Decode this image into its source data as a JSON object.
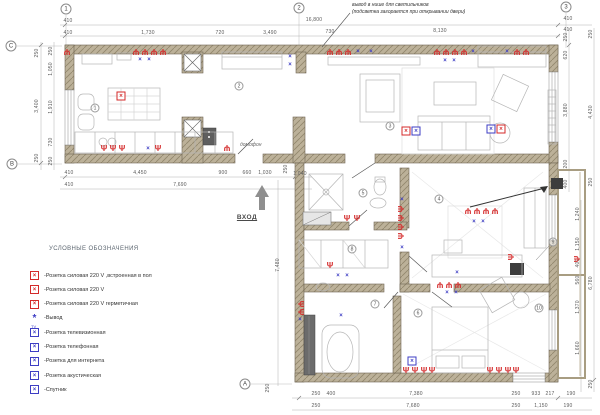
{
  "annotation": {
    "line1": "вывод в нише для светильников",
    "line2": "(подсветка загорается при открывании двери)"
  },
  "entrance": {
    "label": "ВХОД"
  },
  "intercom": {
    "label": "домофон"
  },
  "colors": {
    "socket_red": "#d42a2a",
    "signal_blue": "#3d3dc4",
    "wall_fill": "#b8ad93"
  },
  "legend": {
    "title": "УСЛОВНЫЕ ОБОЗНАЧЕНИЯ",
    "items": [
      {
        "icon": "floor-power-socket-icon",
        "style": "box",
        "color": "#d42a2a",
        "tag": "",
        "label": "-Розетка силовая 220 V ,встроенная в пол"
      },
      {
        "icon": "power-socket-icon",
        "style": "box",
        "color": "#d42a2a",
        "tag": "",
        "label": "-Розетка силовая 220 V"
      },
      {
        "icon": "sealed-power-socket-icon",
        "style": "box",
        "color": "#d42a2a",
        "tag": "",
        "label": "-Розетка силовая 220 V герметичная"
      },
      {
        "icon": "output-icon",
        "style": "dot",
        "color": "#3d3dc4",
        "tag": "",
        "label": "-Вывод"
      },
      {
        "icon": "tv-socket-icon",
        "style": "box",
        "color": "#3d3dc4",
        "tag": "TV",
        "label": "-Розетка телевизионная"
      },
      {
        "icon": "phone-socket-icon",
        "style": "box",
        "color": "#3d3dc4",
        "tag": "",
        "label": "-Розетка  телефонная"
      },
      {
        "icon": "internet-socket-icon",
        "style": "box",
        "color": "#3d3dc4",
        "tag": "",
        "label": "-Розетка  для интернета"
      },
      {
        "icon": "acoustic-socket-icon",
        "style": "box",
        "color": "#3d3dc4",
        "tag": "",
        "label": "-Розетка  акустическая"
      },
      {
        "icon": "satellite-icon",
        "style": "box",
        "color": "#3d3dc4",
        "tag": "",
        "label": "-Спутник"
      }
    ]
  },
  "grid_bubbles": [
    {
      "label": "1",
      "x": 66,
      "y": 9
    },
    {
      "label": "2",
      "x": 299,
      "y": 8
    },
    {
      "label": "3",
      "x": 566,
      "y": 7
    },
    {
      "label": "C",
      "x": 11,
      "y": 46
    },
    {
      "label": "B",
      "x": 12,
      "y": 164
    },
    {
      "label": "A",
      "x": 245,
      "y": 384
    }
  ],
  "room_numbers": [
    {
      "n": "1",
      "x": 95,
      "y": 108
    },
    {
      "n": "2",
      "x": 239,
      "y": 86
    },
    {
      "n": "3",
      "x": 390,
      "y": 126
    },
    {
      "n": "4",
      "x": 439,
      "y": 199
    },
    {
      "n": "5",
      "x": 363,
      "y": 193
    },
    {
      "n": "6",
      "x": 418,
      "y": 313
    },
    {
      "n": "7",
      "x": 375,
      "y": 304
    },
    {
      "n": "8",
      "x": 352,
      "y": 249
    },
    {
      "n": "9",
      "x": 553,
      "y": 242
    },
    {
      "n": "10",
      "x": 539,
      "y": 308
    }
  ],
  "dimensions": [
    {
      "t": "410",
      "x": 68,
      "y": 21
    },
    {
      "t": "16,800",
      "x": 314,
      "y": 20
    },
    {
      "t": "410",
      "x": 568,
      "y": 19
    },
    {
      "t": "410",
      "x": 68,
      "y": 33
    },
    {
      "t": "1,730",
      "x": 148,
      "y": 33
    },
    {
      "t": "720",
      "x": 220,
      "y": 33
    },
    {
      "t": "3,490",
      "x": 270,
      "y": 33
    },
    {
      "t": "730",
      "x": 330,
      "y": 32
    },
    {
      "t": "8,130",
      "x": 440,
      "y": 31
    },
    {
      "t": "410",
      "x": 568,
      "y": 30
    },
    {
      "t": "410",
      "x": 69,
      "y": 173
    },
    {
      "t": "4,450",
      "x": 140,
      "y": 173
    },
    {
      "t": "900",
      "x": 223,
      "y": 173
    },
    {
      "t": "660",
      "x": 247,
      "y": 173
    },
    {
      "t": "1,030",
      "x": 265,
      "y": 173
    },
    {
      "t": "1,040",
      "x": 300,
      "y": 174
    },
    {
      "t": "410",
      "x": 69,
      "y": 185
    },
    {
      "t": "7,690",
      "x": 180,
      "y": 185
    },
    {
      "t": "250",
      "x": 316,
      "y": 394
    },
    {
      "t": "400",
      "x": 331,
      "y": 394
    },
    {
      "t": "7,380",
      "x": 416,
      "y": 394
    },
    {
      "t": "250",
      "x": 516,
      "y": 394
    },
    {
      "t": "933",
      "x": 536,
      "y": 394
    },
    {
      "t": "217",
      "x": 550,
      "y": 394
    },
    {
      "t": "190",
      "x": 571,
      "y": 394
    },
    {
      "t": "250",
      "x": 316,
      "y": 406
    },
    {
      "t": "7,680",
      "x": 413,
      "y": 406
    },
    {
      "t": "250",
      "x": 516,
      "y": 406
    },
    {
      "t": "1,150",
      "x": 541,
      "y": 406
    },
    {
      "t": "190",
      "x": 568,
      "y": 406
    },
    {
      "t": "250",
      "x": 37,
      "y": 53,
      "r": 1
    },
    {
      "t": "3,400",
      "x": 37,
      "y": 106,
      "r": 1
    },
    {
      "t": "250",
      "x": 37,
      "y": 158,
      "r": 1
    },
    {
      "t": "250",
      "x": 51,
      "y": 51,
      "r": 1
    },
    {
      "t": "1,050",
      "x": 51,
      "y": 69,
      "r": 1
    },
    {
      "t": "1,910",
      "x": 51,
      "y": 107,
      "r": 1
    },
    {
      "t": "730",
      "x": 51,
      "y": 142,
      "r": 1
    },
    {
      "t": "250",
      "x": 51,
      "y": 161,
      "r": 1
    },
    {
      "t": "250",
      "x": 566,
      "y": 37,
      "r": 1
    },
    {
      "t": "620",
      "x": 566,
      "y": 55,
      "r": 1
    },
    {
      "t": "3,880",
      "x": 566,
      "y": 110,
      "r": 1
    },
    {
      "t": "200",
      "x": 566,
      "y": 164,
      "r": 1
    },
    {
      "t": "400",
      "x": 566,
      "y": 184,
      "r": 1
    },
    {
      "t": "1,240",
      "x": 578,
      "y": 214,
      "r": 1
    },
    {
      "t": "1,150",
      "x": 578,
      "y": 244,
      "r": 1
    },
    {
      "t": "400",
      "x": 578,
      "y": 263,
      "r": 1
    },
    {
      "t": "560",
      "x": 578,
      "y": 280,
      "r": 1
    },
    {
      "t": "1,370",
      "x": 578,
      "y": 307,
      "r": 1
    },
    {
      "t": "1,660",
      "x": 578,
      "y": 348,
      "r": 1
    },
    {
      "t": "250",
      "x": 591,
      "y": 34,
      "r": 1
    },
    {
      "t": "4,430",
      "x": 591,
      "y": 112,
      "r": 1
    },
    {
      "t": "250",
      "x": 591,
      "y": 182,
      "r": 1
    },
    {
      "t": "6,780",
      "x": 591,
      "y": 283,
      "r": 1
    },
    {
      "t": "250",
      "x": 591,
      "y": 384,
      "r": 1
    },
    {
      "t": "7,480",
      "x": 278,
      "y": 265,
      "r": 1
    },
    {
      "t": "250",
      "x": 286,
      "y": 169,
      "r": 1
    },
    {
      "t": "250",
      "x": 268,
      "y": 388,
      "r": 1
    }
  ],
  "sockets": [
    {
      "k": "p",
      "x": 67,
      "y": 51,
      "r": 180
    },
    {
      "k": "p",
      "x": 136,
      "y": 51,
      "r": 180
    },
    {
      "k": "p",
      "x": 145,
      "y": 51,
      "r": 180
    },
    {
      "k": "p",
      "x": 154,
      "y": 51,
      "r": 180
    },
    {
      "k": "p",
      "x": 163,
      "y": 51,
      "r": 180
    },
    {
      "k": "b",
      "x": 140,
      "y": 60
    },
    {
      "k": "b",
      "x": 149,
      "y": 60
    },
    {
      "k": "b",
      "x": 290,
      "y": 57
    },
    {
      "k": "b",
      "x": 290,
      "y": 65
    },
    {
      "k": "p",
      "x": 330,
      "y": 51,
      "r": 180
    },
    {
      "k": "p",
      "x": 339,
      "y": 51,
      "r": 180
    },
    {
      "k": "p",
      "x": 348,
      "y": 51,
      "r": 180
    },
    {
      "k": "b",
      "x": 358,
      "y": 52
    },
    {
      "k": "b",
      "x": 371,
      "y": 52
    },
    {
      "k": "p",
      "x": 437,
      "y": 51,
      "r": 180
    },
    {
      "k": "p",
      "x": 446,
      "y": 51,
      "r": 180
    },
    {
      "k": "p",
      "x": 455,
      "y": 51,
      "r": 180
    },
    {
      "k": "p",
      "x": 464,
      "y": 51,
      "r": 180
    },
    {
      "k": "b",
      "x": 473,
      "y": 52
    },
    {
      "k": "b",
      "x": 445,
      "y": 61
    },
    {
      "k": "b",
      "x": 454,
      "y": 61
    },
    {
      "k": "b",
      "x": 507,
      "y": 52
    },
    {
      "k": "p",
      "x": 517,
      "y": 51,
      "r": 180
    },
    {
      "k": "p",
      "x": 526,
      "y": 51,
      "r": 180
    },
    {
      "k": "rb",
      "x": 121,
      "y": 96
    },
    {
      "k": "p",
      "x": 104,
      "y": 149
    },
    {
      "k": "p",
      "x": 113,
      "y": 149
    },
    {
      "k": "p",
      "x": 122,
      "y": 149
    },
    {
      "k": "b",
      "x": 148,
      "y": 149
    },
    {
      "k": "p",
      "x": 158,
      "y": 149
    },
    {
      "k": "p",
      "x": 227,
      "y": 147,
      "r": 180
    },
    {
      "k": "rb",
      "x": 406,
      "y": 131
    },
    {
      "k": "bb",
      "x": 416,
      "y": 131
    },
    {
      "k": "bb",
      "x": 491,
      "y": 129
    },
    {
      "k": "rb",
      "x": 501,
      "y": 129
    },
    {
      "k": "b",
      "x": 402,
      "y": 200
    },
    {
      "k": "p",
      "x": 402,
      "y": 209,
      "r": -90
    },
    {
      "k": "p",
      "x": 402,
      "y": 218,
      "r": -90
    },
    {
      "k": "p",
      "x": 402,
      "y": 227,
      "r": -90
    },
    {
      "k": "p",
      "x": 402,
      "y": 236,
      "r": -90
    },
    {
      "k": "b",
      "x": 402,
      "y": 248
    },
    {
      "k": "p",
      "x": 347,
      "y": 219
    },
    {
      "k": "p",
      "x": 357,
      "y": 219
    },
    {
      "k": "p",
      "x": 330,
      "y": 266
    },
    {
      "k": "b",
      "x": 338,
      "y": 276
    },
    {
      "k": "b",
      "x": 347,
      "y": 276
    },
    {
      "k": "p",
      "x": 468,
      "y": 210,
      "r": 180
    },
    {
      "k": "p",
      "x": 477,
      "y": 210,
      "r": 180
    },
    {
      "k": "p",
      "x": 486,
      "y": 210,
      "r": 180
    },
    {
      "k": "p",
      "x": 495,
      "y": 210,
      "r": 180
    },
    {
      "k": "b",
      "x": 474,
      "y": 222
    },
    {
      "k": "b",
      "x": 483,
      "y": 222
    },
    {
      "k": "b",
      "x": 457,
      "y": 273
    },
    {
      "k": "p",
      "x": 512,
      "y": 257,
      "r": -90
    },
    {
      "k": "p",
      "x": 440,
      "y": 284,
      "r": 180
    },
    {
      "k": "p",
      "x": 449,
      "y": 284,
      "r": 180
    },
    {
      "k": "p",
      "x": 458,
      "y": 284,
      "r": 180
    },
    {
      "k": "b",
      "x": 447,
      "y": 293
    },
    {
      "k": "b",
      "x": 456,
      "y": 293
    },
    {
      "k": "p",
      "x": 406,
      "y": 371
    },
    {
      "k": "p",
      "x": 415,
      "y": 371
    },
    {
      "k": "p",
      "x": 424,
      "y": 371
    },
    {
      "k": "p",
      "x": 432,
      "y": 371
    },
    {
      "k": "bb",
      "x": 412,
      "y": 361
    },
    {
      "k": "p",
      "x": 490,
      "y": 371
    },
    {
      "k": "p",
      "x": 499,
      "y": 371
    },
    {
      "k": "p",
      "x": 508,
      "y": 371
    },
    {
      "k": "p",
      "x": 516,
      "y": 371
    },
    {
      "k": "p",
      "x": 300,
      "y": 304,
      "r": 90
    },
    {
      "k": "p",
      "x": 300,
      "y": 312,
      "r": 90
    },
    {
      "k": "b",
      "x": 300,
      "y": 320
    },
    {
      "k": "b",
      "x": 341,
      "y": 316
    },
    {
      "k": "p",
      "x": 578,
      "y": 259,
      "r": -90
    }
  ]
}
